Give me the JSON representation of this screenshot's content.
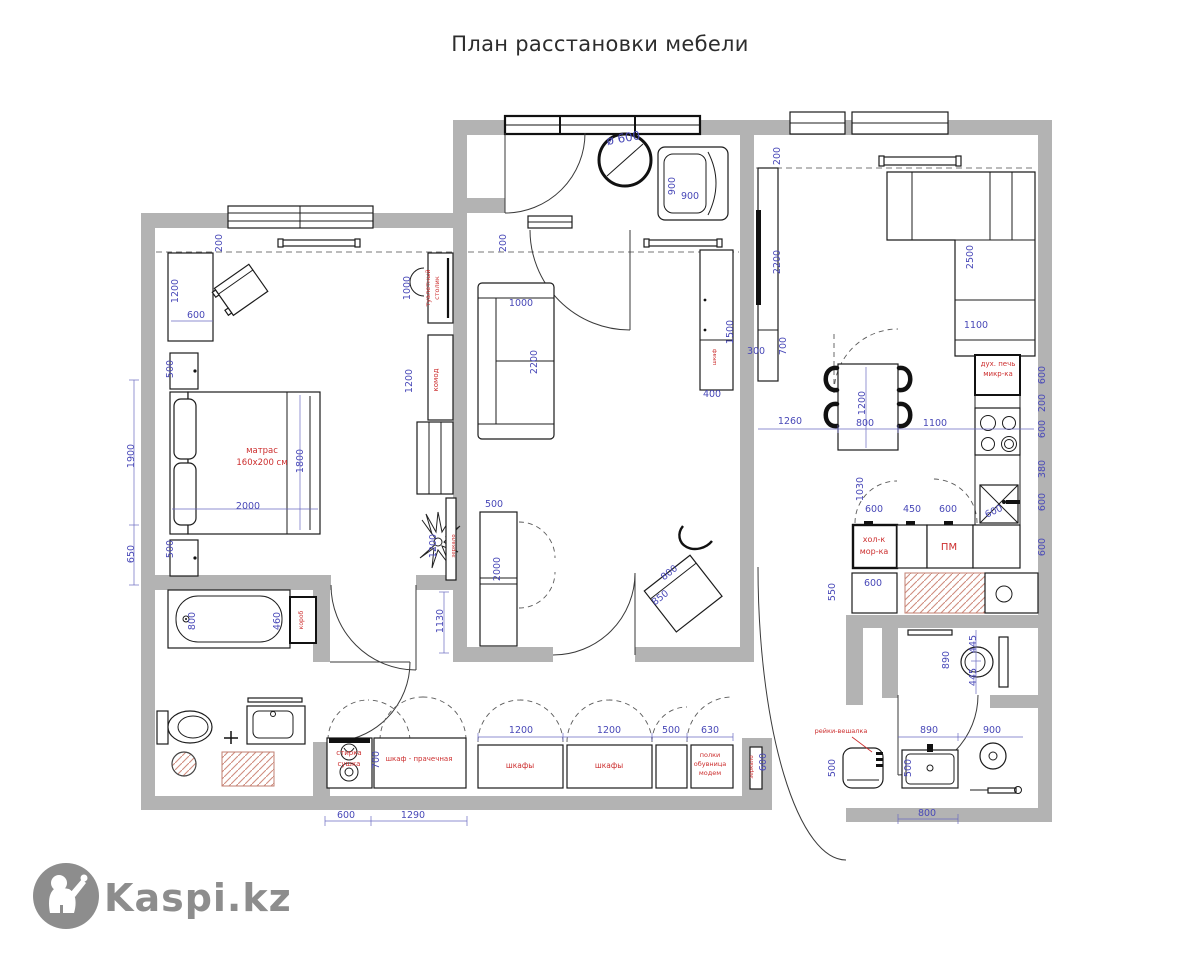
{
  "title": "План расстановки мебели",
  "watermark": {
    "brand": "Kaspi.kz"
  },
  "plan": {
    "dimension_color": "#4949b8",
    "label_color": "#cc2e2e",
    "wall_color": "#b3b3b3",
    "hatch_color": "#cf8d7f",
    "dimensions": [
      {
        "t": "200",
        "x": 222,
        "y": 243,
        "r": -90
      },
      {
        "t": "1200",
        "x": 178,
        "y": 291,
        "r": -90
      },
      {
        "t": "600",
        "x": 196,
        "y": 318,
        "r": 0
      },
      {
        "t": "500",
        "x": 173,
        "y": 369,
        "r": -90
      },
      {
        "t": "500",
        "x": 173,
        "y": 549,
        "r": -90
      },
      {
        "t": "1900",
        "x": 134,
        "y": 456,
        "r": -90
      },
      {
        "t": "650",
        "x": 134,
        "y": 554,
        "r": -90
      },
      {
        "t": "1800",
        "x": 303,
        "y": 461,
        "r": -90
      },
      {
        "t": "2000",
        "x": 248,
        "y": 509,
        "r": 0
      },
      {
        "t": "1000",
        "x": 410,
        "y": 288,
        "r": -90
      },
      {
        "t": "1200",
        "x": 412,
        "y": 381,
        "r": -90
      },
      {
        "t": "200",
        "x": 506,
        "y": 243,
        "r": -90
      },
      {
        "t": "1000",
        "x": 521,
        "y": 306,
        "r": 0
      },
      {
        "t": "2200",
        "x": 537,
        "y": 362,
        "r": -90
      },
      {
        "t": "500",
        "x": 494,
        "y": 507,
        "r": 0
      },
      {
        "t": "2000",
        "x": 500,
        "y": 569,
        "r": -90
      },
      {
        "t": "1130",
        "x": 443,
        "y": 621,
        "r": -90
      },
      {
        "t": "1200",
        "x": 436,
        "y": 546,
        "r": -90
      },
      {
        "t": "1500",
        "x": 733,
        "y": 332,
        "r": -90
      },
      {
        "t": "400",
        "x": 712,
        "y": 397,
        "r": 0
      },
      {
        "t": "800",
        "x": 671,
        "y": 575,
        "r": -38
      },
      {
        "t": "850",
        "x": 662,
        "y": 600,
        "r": -38
      },
      {
        "t": "ø 600",
        "x": 624,
        "y": 142,
        "r": -10,
        "fs": 12
      },
      {
        "t": "900",
        "x": 675,
        "y": 186,
        "r": -90
      },
      {
        "t": "900",
        "x": 690,
        "y": 199,
        "r": 0
      },
      {
        "t": "200",
        "x": 780,
        "y": 156,
        "r": -90
      },
      {
        "t": "2200",
        "x": 780,
        "y": 262,
        "r": -90
      },
      {
        "t": "700",
        "x": 786,
        "y": 346,
        "r": -90
      },
      {
        "t": "300",
        "x": 756,
        "y": 354,
        "r": 0
      },
      {
        "t": "2500",
        "x": 973,
        "y": 257,
        "r": -90
      },
      {
        "t": "1100",
        "x": 976,
        "y": 328,
        "r": 0
      },
      {
        "t": "1260",
        "x": 790,
        "y": 424,
        "r": 0
      },
      {
        "t": "1200",
        "x": 865,
        "y": 403,
        "r": -90
      },
      {
        "t": "800",
        "x": 865,
        "y": 426,
        "r": 0
      },
      {
        "t": "1100",
        "x": 935,
        "y": 426,
        "r": 0
      },
      {
        "t": "1030",
        "x": 863,
        "y": 489,
        "r": -90
      },
      {
        "t": "600",
        "x": 874,
        "y": 512,
        "r": 0
      },
      {
        "t": "450",
        "x": 912,
        "y": 512,
        "r": 0
      },
      {
        "t": "600",
        "x": 948,
        "y": 512,
        "r": 0
      },
      {
        "t": "600",
        "x": 995,
        "y": 514,
        "r": -25
      },
      {
        "t": "600",
        "x": 1045,
        "y": 375,
        "r": -90
      },
      {
        "t": "200",
        "x": 1045,
        "y": 403,
        "r": -90
      },
      {
        "t": "600",
        "x": 1045,
        "y": 429,
        "r": -90
      },
      {
        "t": "380",
        "x": 1045,
        "y": 469,
        "r": -90
      },
      {
        "t": "600",
        "x": 1045,
        "y": 502,
        "r": -90
      },
      {
        "t": "600",
        "x": 1045,
        "y": 547,
        "r": -90
      },
      {
        "t": "600",
        "x": 873,
        "y": 586,
        "r": 0
      },
      {
        "t": "550",
        "x": 835,
        "y": 592,
        "r": -90
      },
      {
        "t": "890",
        "x": 949,
        "y": 660,
        "r": -90
      },
      {
        "t": "445",
        "x": 976,
        "y": 644,
        "r": -90
      },
      {
        "t": "445",
        "x": 976,
        "y": 677,
        "r": -90
      },
      {
        "t": "890",
        "x": 929,
        "y": 733,
        "r": 0
      },
      {
        "t": "900",
        "x": 992,
        "y": 733,
        "r": 0
      },
      {
        "t": "500",
        "x": 911,
        "y": 768,
        "r": -90
      },
      {
        "t": "800",
        "x": 927,
        "y": 816,
        "r": 0
      },
      {
        "t": "500",
        "x": 835,
        "y": 768,
        "r": -90
      },
      {
        "t": "700",
        "x": 379,
        "y": 760,
        "r": -90
      },
      {
        "t": "600",
        "x": 346,
        "y": 818,
        "r": 0
      },
      {
        "t": "1290",
        "x": 413,
        "y": 818,
        "r": 0
      },
      {
        "t": "1200",
        "x": 521,
        "y": 733,
        "r": 0
      },
      {
        "t": "1200",
        "x": 609,
        "y": 733,
        "r": 0
      },
      {
        "t": "500",
        "x": 671,
        "y": 733,
        "r": 0
      },
      {
        "t": "630",
        "x": 710,
        "y": 733,
        "r": 0
      },
      {
        "t": "600",
        "x": 766,
        "y": 762,
        "r": -90
      },
      {
        "t": "800",
        "x": 195,
        "y": 621,
        "r": -90
      },
      {
        "t": "460",
        "x": 280,
        "y": 621,
        "r": -90
      }
    ],
    "furniture_labels": [
      {
        "t": "матрас",
        "x": 262,
        "y": 453,
        "r": 0,
        "fs": 8.5
      },
      {
        "t": "160x200 см",
        "x": 262,
        "y": 465,
        "r": 0,
        "fs": 8.5
      },
      {
        "t": "туалетный",
        "x": 430,
        "y": 288,
        "r": -90,
        "fs": 6.5
      },
      {
        "t": "столик",
        "x": 439,
        "y": 288,
        "r": -90,
        "fs": 6.5
      },
      {
        "t": "комод",
        "x": 438,
        "y": 380,
        "r": -90,
        "fs": 7
      },
      {
        "t": "зеркало",
        "x": 455,
        "y": 546,
        "r": -90,
        "fs": 5.5
      },
      {
        "t": "короб",
        "x": 303,
        "y": 620,
        "r": -90,
        "fs": 6
      },
      {
        "t": "шкаф",
        "x": 716,
        "y": 357,
        "r": -90,
        "fs": 5.5
      },
      {
        "t": "дух. печь",
        "x": 998,
        "y": 366,
        "r": 0,
        "fs": 7
      },
      {
        "t": "микр-ка",
        "x": 998,
        "y": 376,
        "r": 0,
        "fs": 7
      },
      {
        "t": "хол-к",
        "x": 874,
        "y": 542,
        "r": 0,
        "fs": 8
      },
      {
        "t": "мор-ка",
        "x": 874,
        "y": 554,
        "r": 0,
        "fs": 8
      },
      {
        "t": "ПМ",
        "x": 949,
        "y": 550,
        "r": 0,
        "fs": 10
      },
      {
        "t": "рейки-вешалка",
        "x": 841,
        "y": 733,
        "r": 0,
        "fs": 6.5
      },
      {
        "t": "стирка",
        "x": 349,
        "y": 755,
        "r": 0,
        "fs": 7
      },
      {
        "t": "сушка",
        "x": 349,
        "y": 766,
        "r": 0,
        "fs": 7
      },
      {
        "t": "шкаф - прачечная",
        "x": 419,
        "y": 761,
        "r": 0,
        "fs": 7
      },
      {
        "t": "шкафы",
        "x": 520,
        "y": 768,
        "r": 0,
        "fs": 7.5
      },
      {
        "t": "шкафы",
        "x": 609,
        "y": 768,
        "r": 0,
        "fs": 7.5
      },
      {
        "t": "полки",
        "x": 710,
        "y": 757,
        "r": 0,
        "fs": 6.5
      },
      {
        "t": "обувница",
        "x": 710,
        "y": 766,
        "r": 0,
        "fs": 6.5
      },
      {
        "t": "модем",
        "x": 710,
        "y": 775,
        "r": 0,
        "fs": 6.5
      },
      {
        "t": "зеркало",
        "x": 753,
        "y": 767,
        "r": -90,
        "fs": 5.5
      }
    ]
  }
}
